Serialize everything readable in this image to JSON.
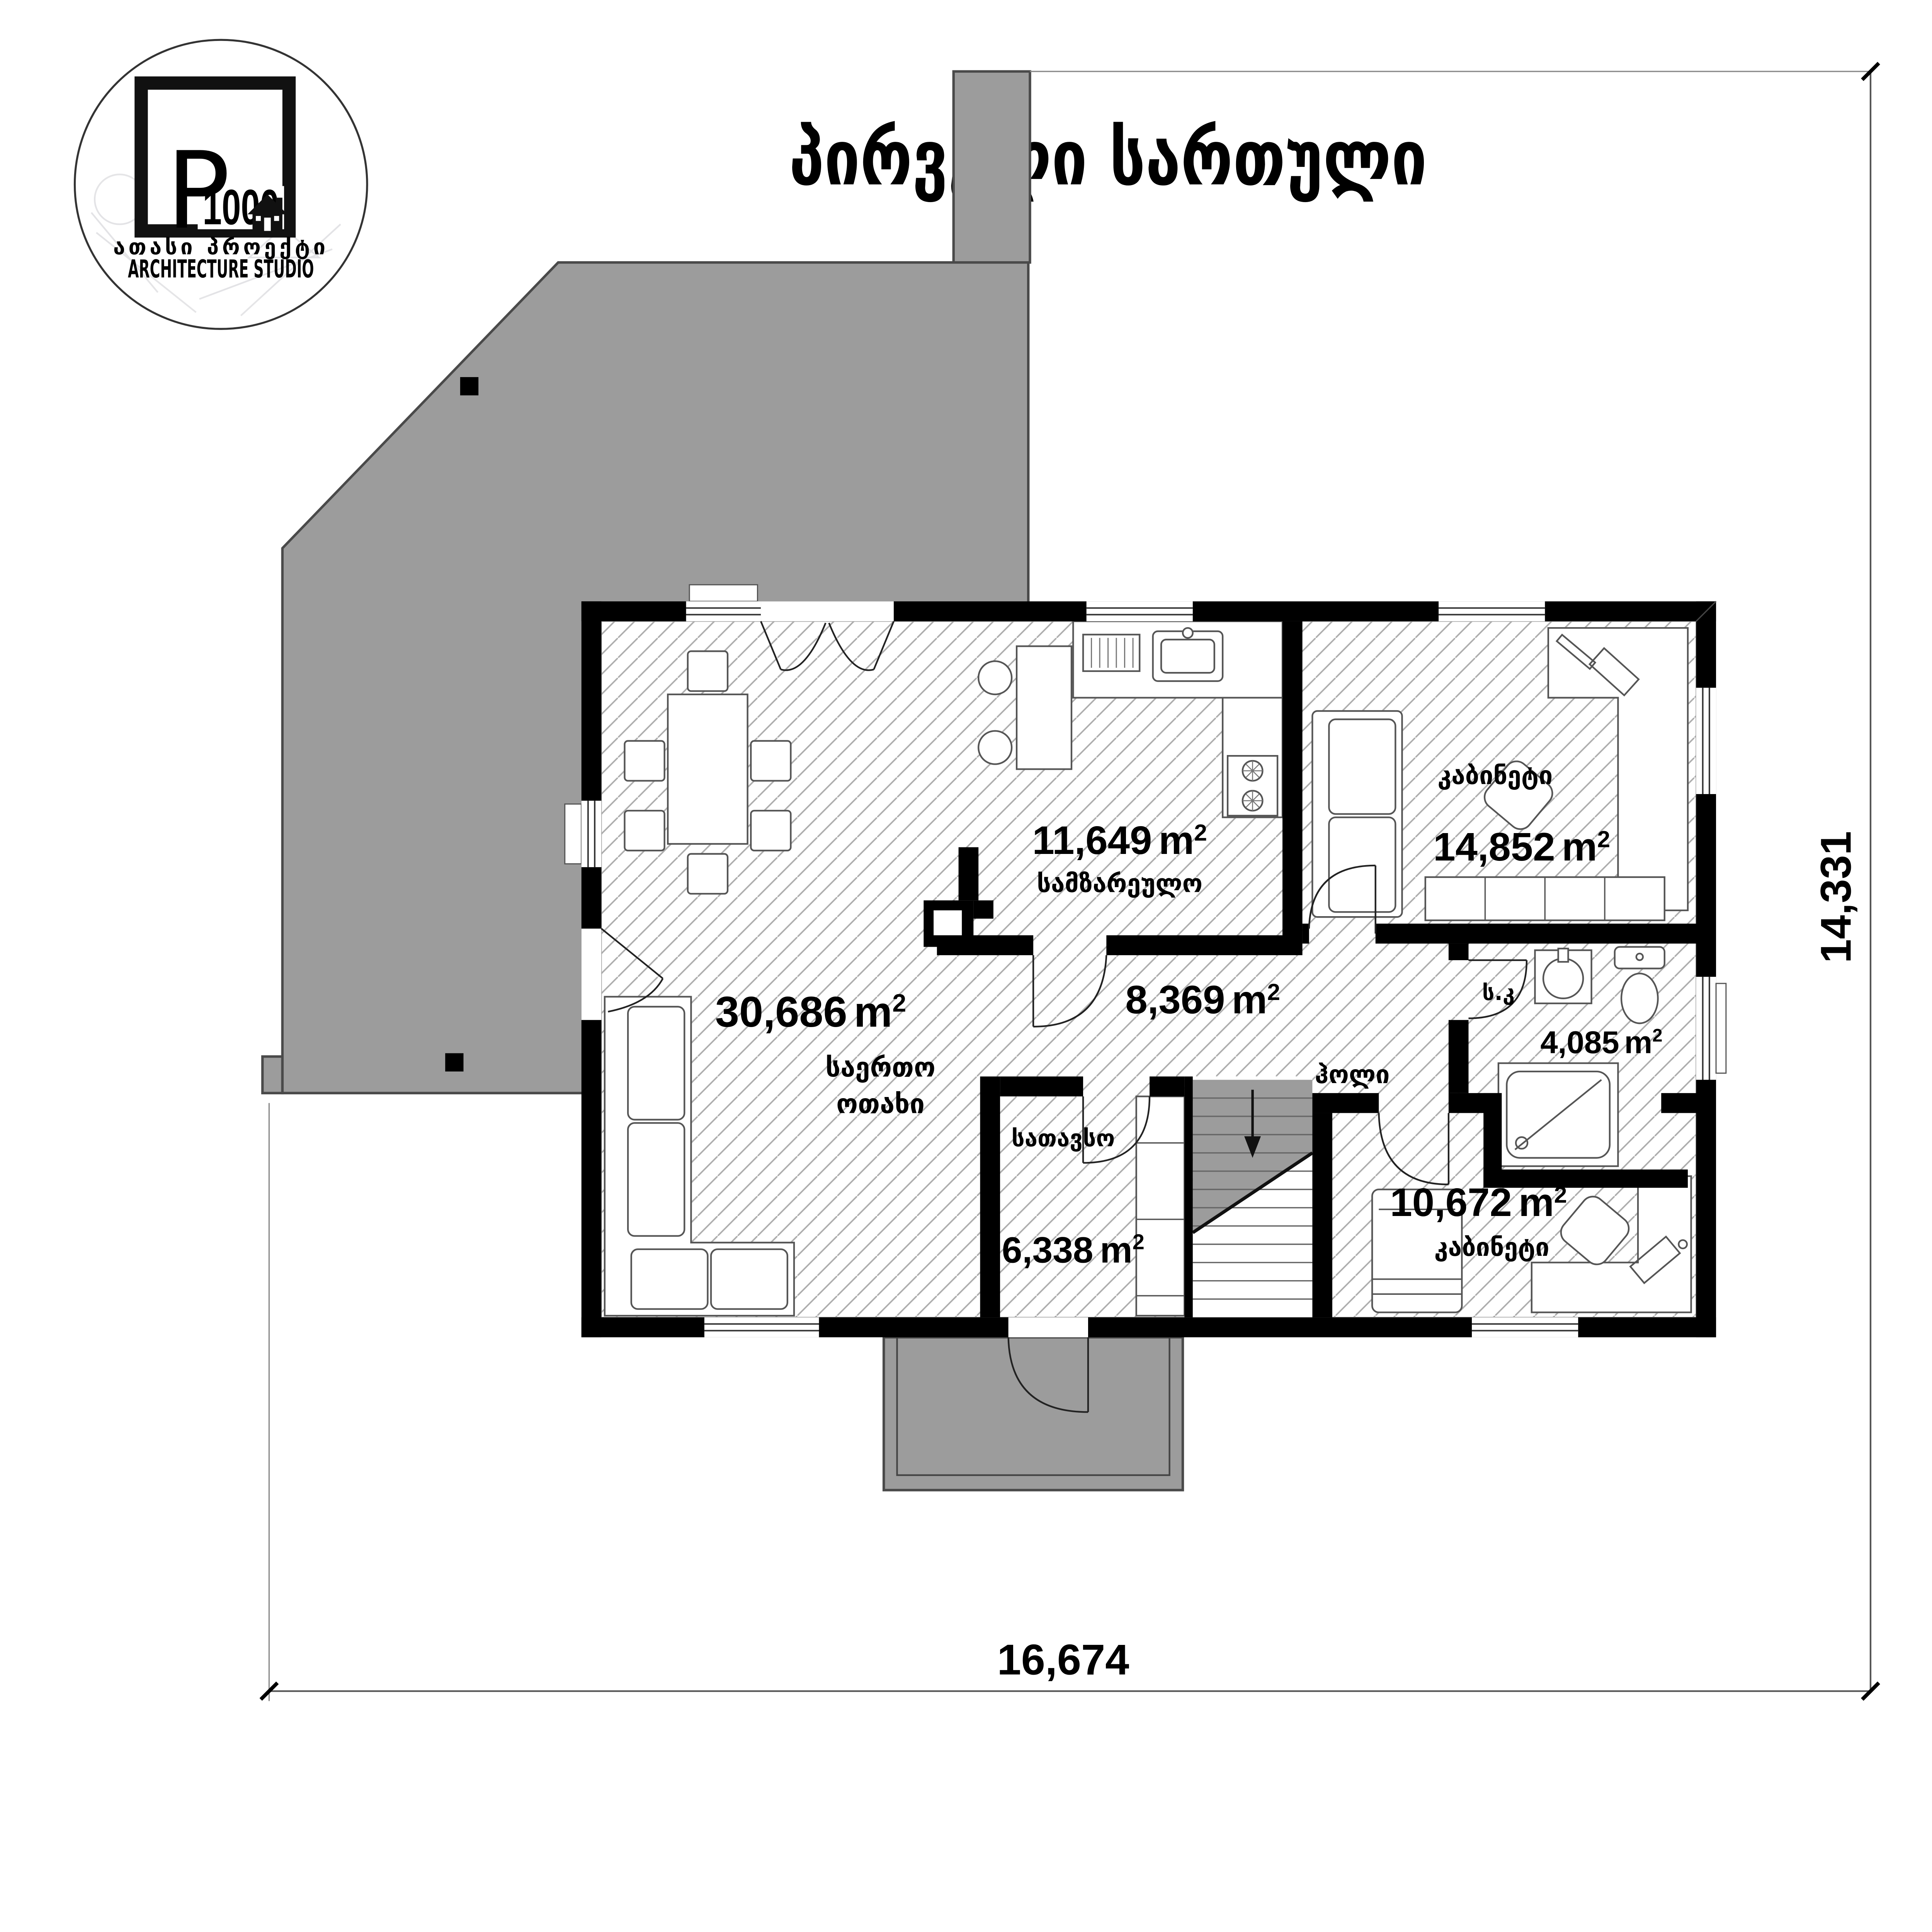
{
  "logo": {
    "letter": "P",
    "number": "1000",
    "tagline": "ათასი პროექტი",
    "subtitle": "ARCHITECTURE STUDIO"
  },
  "title": "პირველი სართული",
  "rooms": [
    {
      "id": "kitchen",
      "name": "სამზარეულო",
      "area": "11,649",
      "unit": "m",
      "sup": "2"
    },
    {
      "id": "office-upper",
      "name": "კაბინეტი",
      "area": "14,852",
      "unit": "m",
      "sup": "2"
    },
    {
      "id": "living-room",
      "name_line1": "საერთო",
      "name_line2": "ოთახი",
      "area": "30,686",
      "unit": "m",
      "sup": "2"
    },
    {
      "id": "hall",
      "name": "ჰოლი",
      "area": "8,369",
      "unit": "m",
      "sup": "2"
    },
    {
      "id": "bathroom",
      "name": "ს.კ",
      "area": "4,085",
      "unit": "m",
      "sup": "2"
    },
    {
      "id": "storage",
      "name": "სათავსო",
      "area": "6,338",
      "unit": "m",
      "sup": "2"
    },
    {
      "id": "office-lower",
      "name": "კაბინეტი",
      "area": "10,672",
      "unit": "m",
      "sup": "2"
    }
  ],
  "dimensions": {
    "width": "16,674",
    "height": "14,331"
  },
  "colors": {
    "terrace_gray": "#9c9c9c",
    "wall_black": "#000000",
    "hatch_line": "#adadad"
  }
}
